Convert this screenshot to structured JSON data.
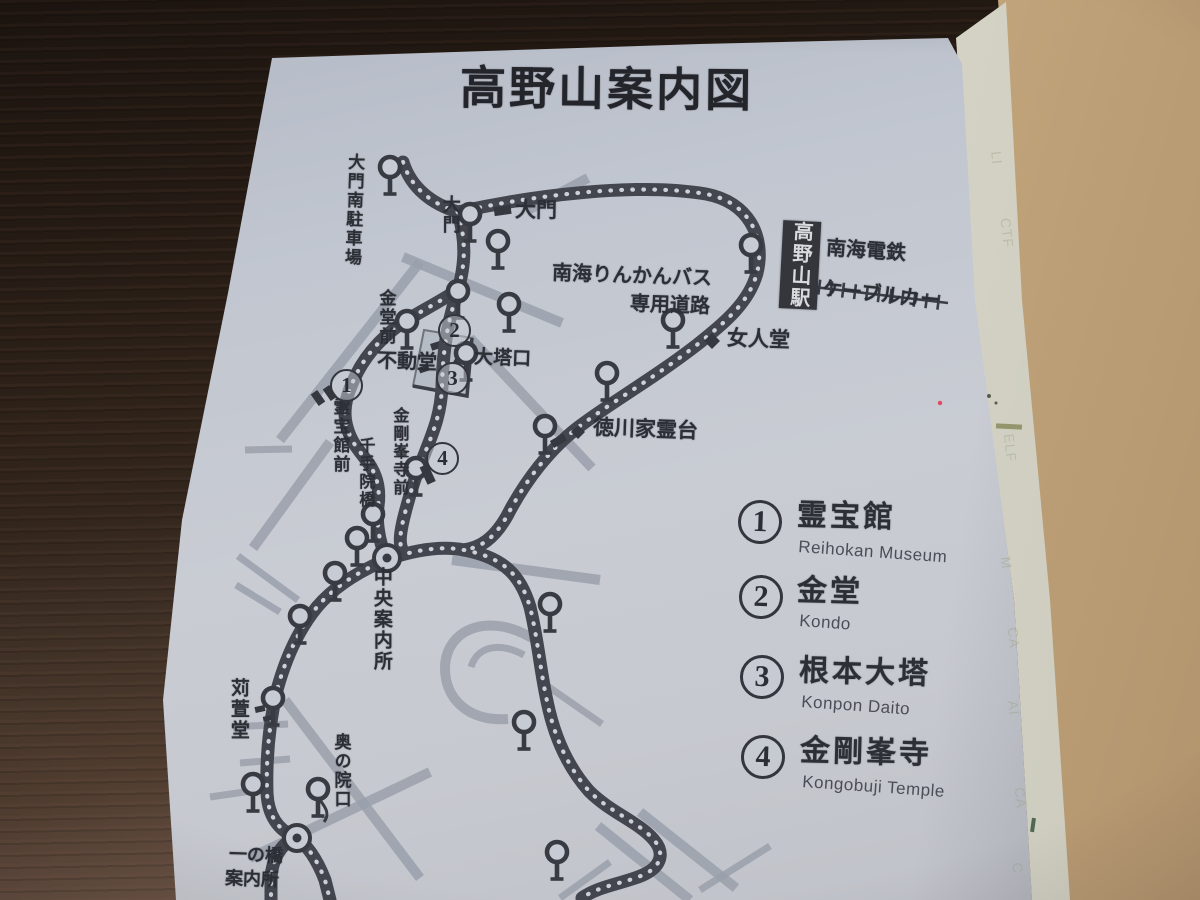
{
  "title": "高野山案内図",
  "station": {
    "name": "高野山駅"
  },
  "railway": {
    "company": "南海電鉄",
    "line": "ケーブルカー"
  },
  "bus_road": {
    "line1": "南海りんかんバス",
    "line2": "専用道路"
  },
  "places": {
    "daimon_parking": "大門南駐車場",
    "daimon_stop": "大門",
    "daimon_gate": "大門",
    "kondo_mae": "金堂前",
    "fudodo": "不動堂",
    "daitoguchi": "大塔口",
    "reihokan_mae": "霊宝館前",
    "kongobuji_mae": "金剛峯寺前",
    "senjuinbashi": "千手院橋",
    "nyonindo": "女人堂",
    "tokugawa_reidai": "徳川家霊台",
    "chuo_annaijo": "中央案内所",
    "karukayado": "苅萱堂",
    "okunoin_guchi": "奥の院口",
    "ichinohashi_line1": "一の橋",
    "ichinohashi_line2": "案内所"
  },
  "map_numbers": [
    "1",
    "2",
    "3",
    "4"
  ],
  "legend": {
    "items": [
      {
        "number": "1",
        "name": "霊宝館",
        "romaji": "Reihokan Museum"
      },
      {
        "number": "2",
        "name": "金堂",
        "romaji": "Kondo"
      },
      {
        "number": "3",
        "name": "根本大塔",
        "romaji": "Konpon Daito"
      },
      {
        "number": "4",
        "name": "金剛峯寺",
        "romaji": "Kongobuji Temple"
      }
    ]
  },
  "page_edge_showthrough": [
    "LI",
    "CTF",
    "ELF",
    "M",
    "CA",
    "AI",
    "CA",
    "C"
  ]
}
